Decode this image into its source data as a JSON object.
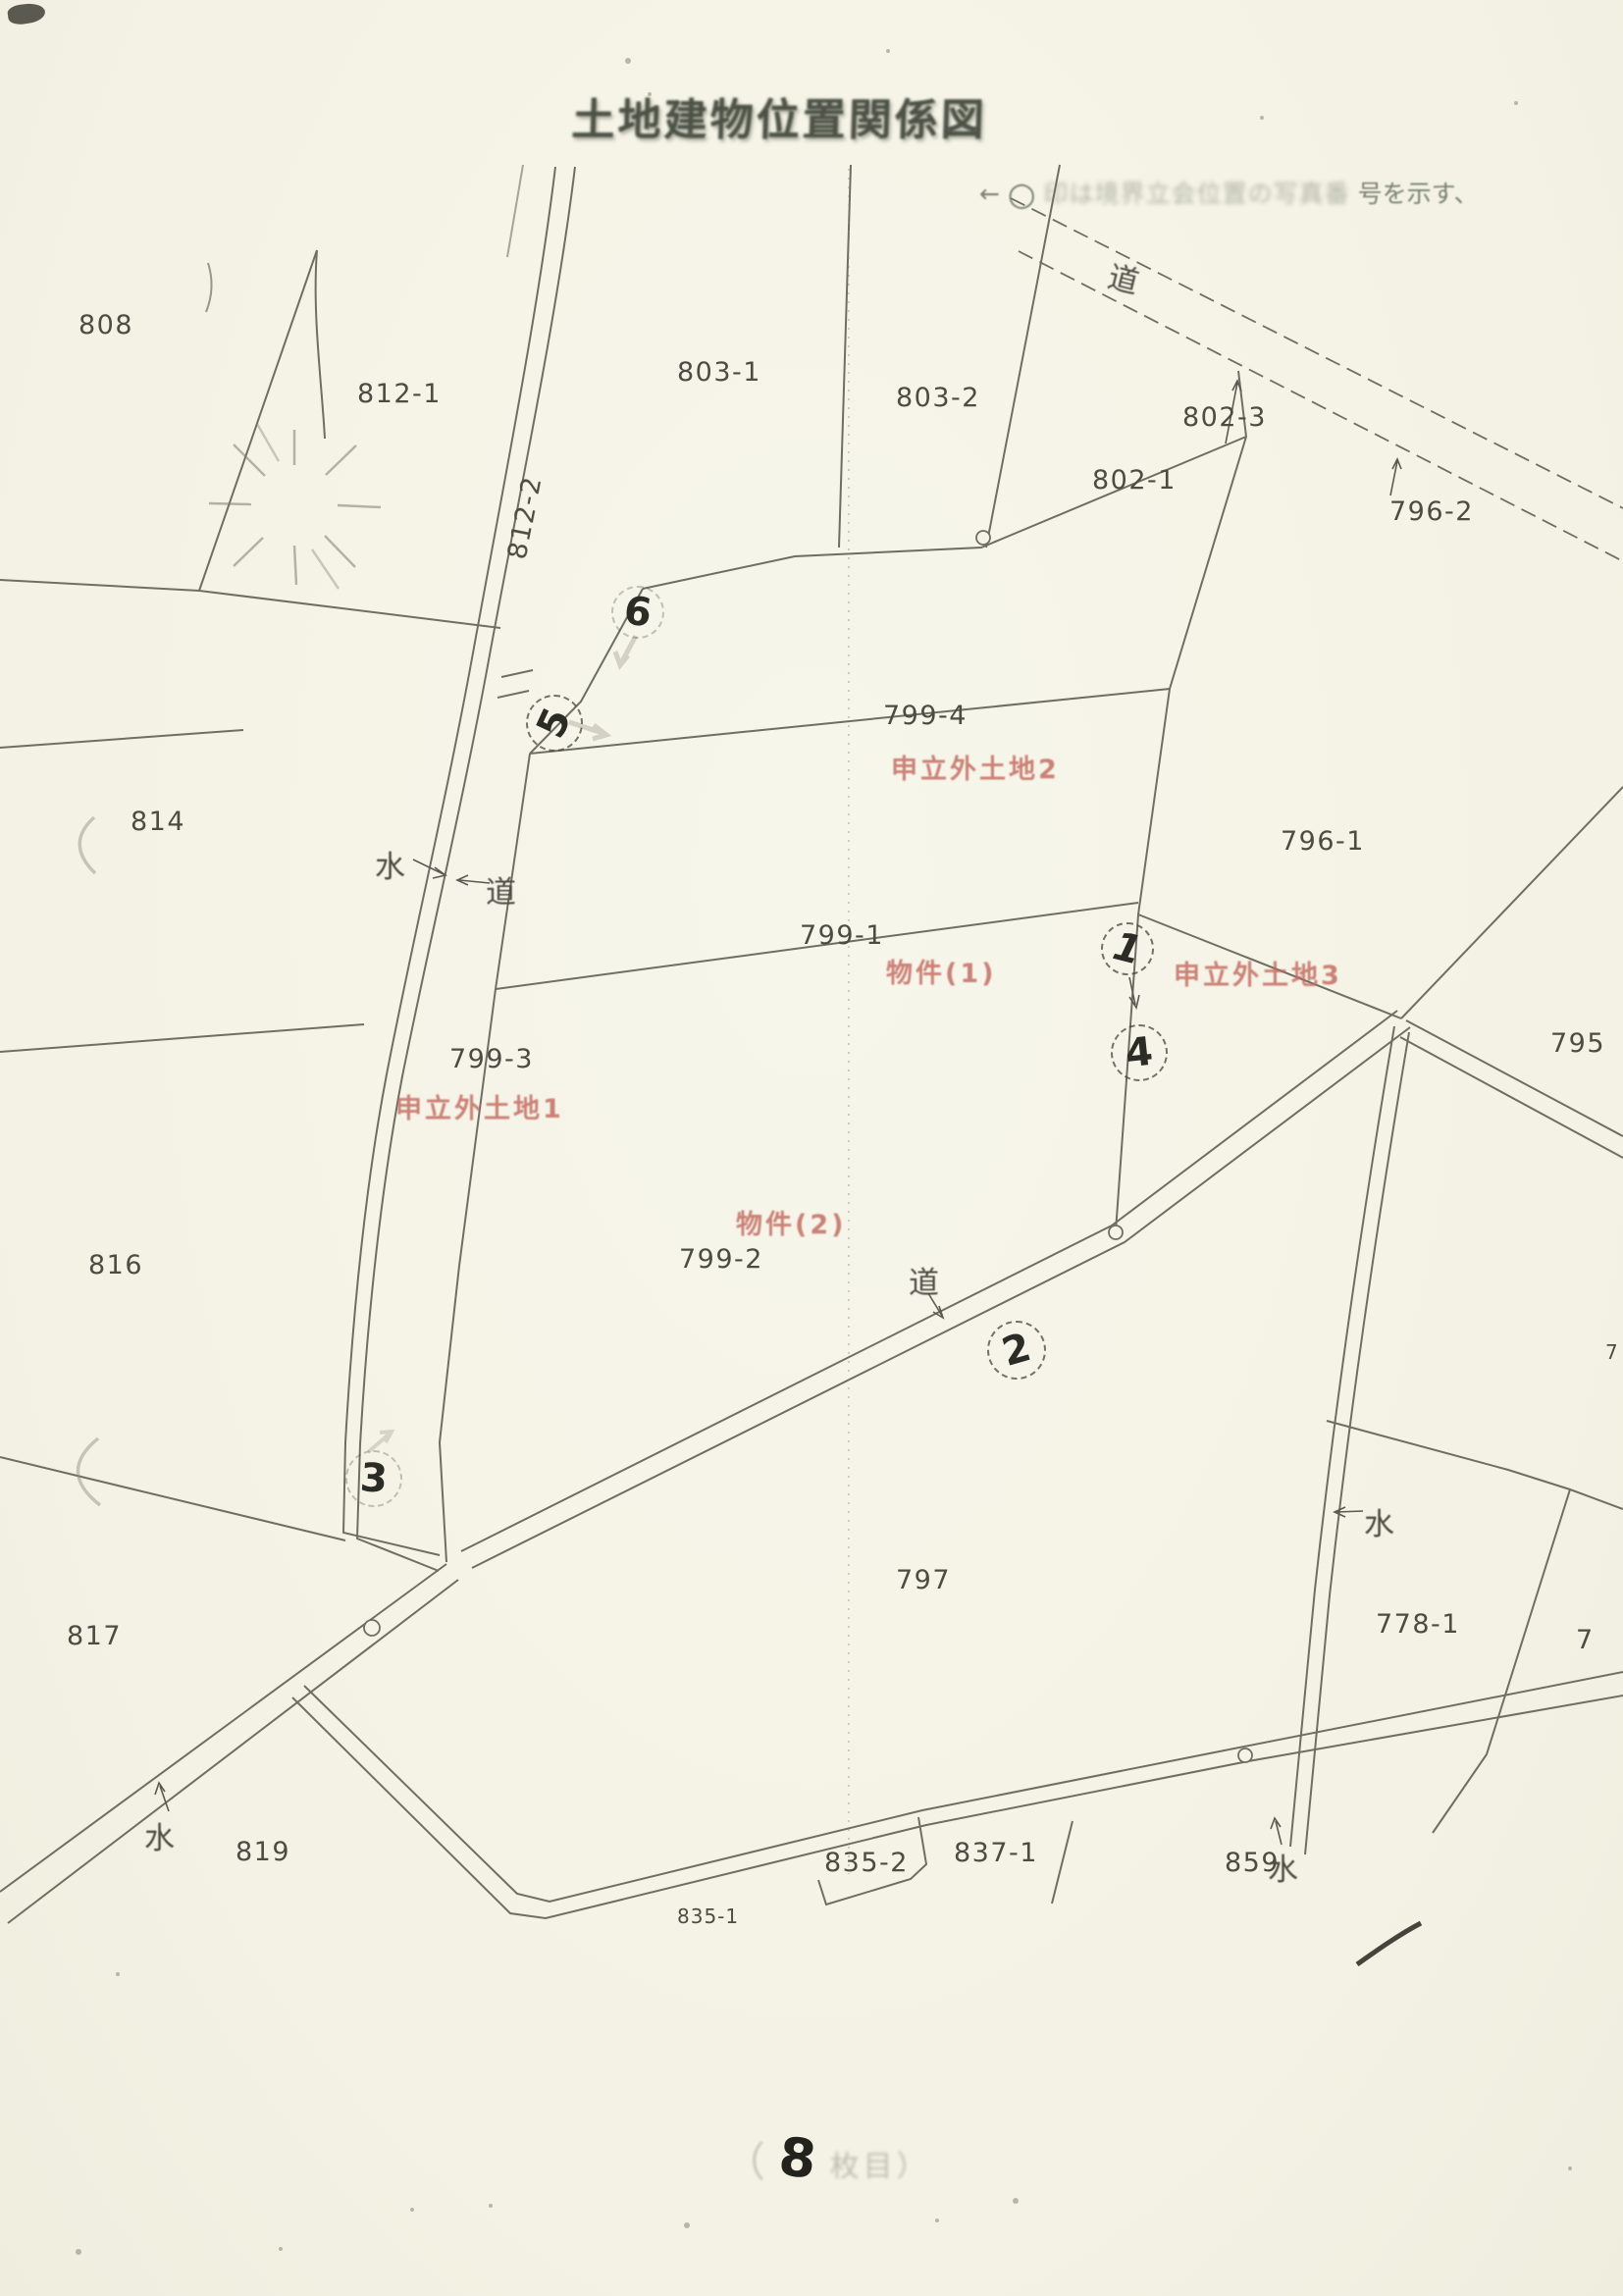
{
  "page": {
    "title": "土地建物位置関係図",
    "legend_note": {
      "arrow": "←",
      "circle_mark": "○",
      "faint_text": "印は境界立会位置の写真番",
      "clear_text": "号を示す、"
    },
    "sheet_note": {
      "paren_open": "（",
      "sheet_number": "8",
      "suffix": "枚目）"
    }
  },
  "colors": {
    "paper": "#f5f3e7",
    "line_ink": "#6e6e63",
    "red_stamp": "#c2685e",
    "title_ink": "#4d5246"
  },
  "parcel_labels": [
    {
      "text": "808"
    },
    {
      "text": "812-1"
    },
    {
      "text": "812-2"
    },
    {
      "text": "803-1"
    },
    {
      "text": "803-2"
    },
    {
      "text": "802-3"
    },
    {
      "text": "802-1"
    },
    {
      "text": "796-2"
    },
    {
      "text": "799-4"
    },
    {
      "text": "796-1"
    },
    {
      "text": "814"
    },
    {
      "text": "799-1"
    },
    {
      "text": "795"
    },
    {
      "text": "799-3"
    },
    {
      "text": "816"
    },
    {
      "text": "799-2"
    },
    {
      "text": "797"
    },
    {
      "text": "817"
    },
    {
      "text": "778-1"
    },
    {
      "text": "7"
    },
    {
      "text": "7"
    },
    {
      "text": "819"
    },
    {
      "text": "835-2"
    },
    {
      "text": "835-1"
    },
    {
      "text": "837-1"
    },
    {
      "text": "859"
    }
  ],
  "road_water_labels": [
    {
      "text": "道"
    },
    {
      "text": "水"
    },
    {
      "text": "道"
    },
    {
      "text": "道"
    },
    {
      "text": "水"
    },
    {
      "text": "水"
    },
    {
      "text": "水"
    }
  ],
  "red_stamps": [
    {
      "text": "申立外土地2"
    },
    {
      "text": "物件(1)"
    },
    {
      "text": "申立外土地3"
    },
    {
      "text": "申立外土地1"
    },
    {
      "text": "物件(2)"
    }
  ],
  "circled_numbers": [
    {
      "text": "6"
    },
    {
      "text": "5"
    },
    {
      "text": "1"
    },
    {
      "text": "4"
    },
    {
      "text": "2"
    },
    {
      "text": "3"
    }
  ]
}
